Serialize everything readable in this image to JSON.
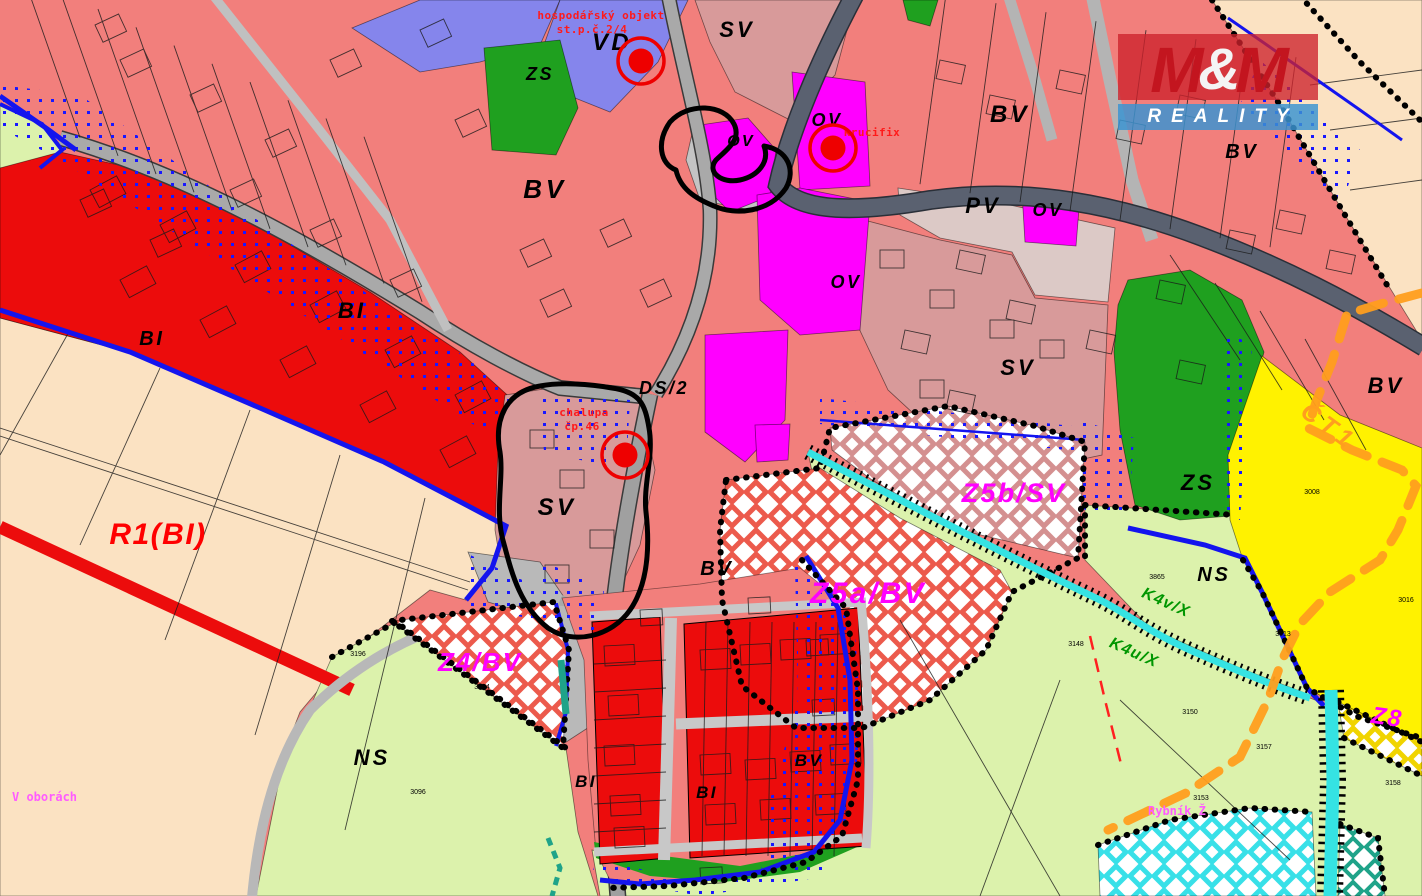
{
  "watermark": {
    "m_left": "M",
    "amp": "&",
    "m_right": "M",
    "word": "REALITY"
  },
  "colors": {
    "bv_salmon": "#F27F7C",
    "bi_red": "#EC0C0C",
    "sv_pink": "#D89A9A",
    "pv_pale": "#DCC9C6",
    "ov_magenta": "#FF00FF",
    "vd_violet": "#8585EC",
    "zs_green": "#1FA01F",
    "ns_lightgreen": "#DCF2AC",
    "reserve_cream": "#FBE2C2",
    "ct_yellow": "#FFF200",
    "road_gray": "#A9A9A9",
    "road_dark": "#5A6170",
    "water_cyan": "#35E3E3",
    "teal": "#1FA389",
    "boundary_blue": "#1414EE",
    "route_orange": "#FF9E1E",
    "label_magenta": "#FF00FF",
    "label_green": "#009600",
    "note_red": "#FF1A1A",
    "place_magenta": "#FF5CFF",
    "marker_red": "#EE0000"
  },
  "markers": {
    "points": [
      [
        641,
        61
      ],
      [
        833,
        148
      ],
      [
        625,
        455
      ]
    ]
  },
  "labels": {
    "items": [
      {
        "t": "VD",
        "x": 612,
        "y": 50,
        "s": 24,
        "k": "zone"
      },
      {
        "t": "SV",
        "x": 737,
        "y": 37,
        "s": 22,
        "k": "zone"
      },
      {
        "t": "ZS",
        "x": 540,
        "y": 80,
        "s": 18,
        "k": "zone"
      },
      {
        "t": "BV",
        "x": 545,
        "y": 198,
        "s": 26,
        "k": "zone"
      },
      {
        "t": "OV",
        "x": 741,
        "y": 146,
        "s": 16,
        "k": "zone"
      },
      {
        "t": "OV",
        "x": 827,
        "y": 126,
        "s": 18,
        "k": "zone"
      },
      {
        "t": "OV",
        "x": 846,
        "y": 288,
        "s": 18,
        "k": "zone"
      },
      {
        "t": "OV",
        "x": 1048,
        "y": 216,
        "s": 18,
        "k": "zone"
      },
      {
        "t": "BV",
        "x": 1010,
        "y": 122,
        "s": 24,
        "k": "zone"
      },
      {
        "t": "BV",
        "x": 1242,
        "y": 158,
        "s": 20,
        "k": "zone"
      },
      {
        "t": "PV",
        "x": 983,
        "y": 213,
        "s": 22,
        "k": "zone"
      },
      {
        "t": "BI",
        "x": 352,
        "y": 318,
        "s": 22,
        "k": "zone"
      },
      {
        "t": "BI",
        "x": 152,
        "y": 345,
        "s": 20,
        "k": "zone"
      },
      {
        "t": "DS/2",
        "x": 664,
        "y": 394,
        "s": 18,
        "k": "zone"
      },
      {
        "t": "SV",
        "x": 557,
        "y": 515,
        "s": 24,
        "k": "zone"
      },
      {
        "t": "SV",
        "x": 1018,
        "y": 375,
        "s": 22,
        "k": "zone"
      },
      {
        "t": "BV",
        "x": 717,
        "y": 575,
        "s": 20,
        "k": "zone"
      },
      {
        "t": "ZS",
        "x": 1198,
        "y": 490,
        "s": 22,
        "k": "zone"
      },
      {
        "t": "BV",
        "x": 1386,
        "y": 393,
        "s": 22,
        "k": "zone"
      },
      {
        "t": "NS",
        "x": 1214,
        "y": 581,
        "s": 20,
        "k": "zone"
      },
      {
        "t": "NS",
        "x": 372,
        "y": 765,
        "s": 22,
        "k": "zone"
      },
      {
        "t": "BI",
        "x": 586,
        "y": 787,
        "s": 17,
        "k": "zone"
      },
      {
        "t": "BI",
        "x": 707,
        "y": 798,
        "s": 17,
        "k": "zone"
      },
      {
        "t": "BV",
        "x": 809,
        "y": 766,
        "s": 17,
        "k": "zone"
      },
      {
        "t": "Z4/BV",
        "x": 480,
        "y": 671,
        "s": 26,
        "k": "dev"
      },
      {
        "t": "Z5a/BV",
        "x": 868,
        "y": 603,
        "s": 30,
        "k": "dev"
      },
      {
        "t": "Z5b/SV",
        "x": 1014,
        "y": 502,
        "s": 27,
        "k": "dev"
      },
      {
        "t": "Z8",
        "x": 1386,
        "y": 725,
        "s": 24,
        "k": "dev",
        "r": 8
      },
      {
        "t": "R1(BI)",
        "x": 158,
        "y": 544,
        "s": 30,
        "k": "res"
      },
      {
        "t": "ČT1",
        "x": 1324,
        "y": 433,
        "s": 25,
        "k": "route",
        "r": 36
      },
      {
        "t": "K4v/X",
        "x": 1164,
        "y": 607,
        "s": 16,
        "k": "cor",
        "r": 24
      },
      {
        "t": "K4u/X",
        "x": 1132,
        "y": 657,
        "s": 16,
        "k": "cor",
        "r": 24
      },
      {
        "t": "hospodářský objekt",
        "x": 601,
        "y": 19,
        "s": 11,
        "k": "note"
      },
      {
        "t": "st.p.č.2/4",
        "x": 592,
        "y": 33,
        "s": 11,
        "k": "note"
      },
      {
        "t": "krucifix",
        "x": 872,
        "y": 136,
        "s": 11,
        "k": "note"
      },
      {
        "t": "chalupa",
        "x": 584,
        "y": 416,
        "s": 11,
        "k": "note"
      },
      {
        "t": "čp.46",
        "x": 582,
        "y": 430,
        "s": 11,
        "k": "note"
      },
      {
        "t": "V oborách",
        "x": 12,
        "y": 801,
        "s": 12,
        "k": "place",
        "a": "start"
      },
      {
        "t": "Rybník Ž",
        "x": 1148,
        "y": 815,
        "s": 12,
        "k": "place",
        "a": "start"
      },
      {
        "t": "3196",
        "x": 358,
        "y": 656,
        "s": 7,
        "k": "parcel"
      },
      {
        "t": "3194",
        "x": 482,
        "y": 689,
        "s": 7,
        "k": "parcel"
      },
      {
        "t": "3096",
        "x": 418,
        "y": 794,
        "s": 7,
        "k": "parcel"
      },
      {
        "t": "3865",
        "x": 1157,
        "y": 579,
        "s": 7,
        "k": "parcel"
      },
      {
        "t": "3148",
        "x": 1076,
        "y": 646,
        "s": 7,
        "k": "parcel"
      },
      {
        "t": "3013",
        "x": 1283,
        "y": 636,
        "s": 7,
        "k": "parcel"
      },
      {
        "t": "3016",
        "x": 1406,
        "y": 602,
        "s": 7,
        "k": "parcel"
      },
      {
        "t": "3008",
        "x": 1312,
        "y": 494,
        "s": 7,
        "k": "parcel"
      },
      {
        "t": "3150",
        "x": 1190,
        "y": 714,
        "s": 7,
        "k": "parcel"
      },
      {
        "t": "3157",
        "x": 1264,
        "y": 749,
        "s": 7,
        "k": "parcel"
      },
      {
        "t": "3153",
        "x": 1201,
        "y": 800,
        "s": 7,
        "k": "parcel"
      },
      {
        "t": "3158",
        "x": 1393,
        "y": 785,
        "s": 7,
        "k": "parcel"
      }
    ]
  }
}
